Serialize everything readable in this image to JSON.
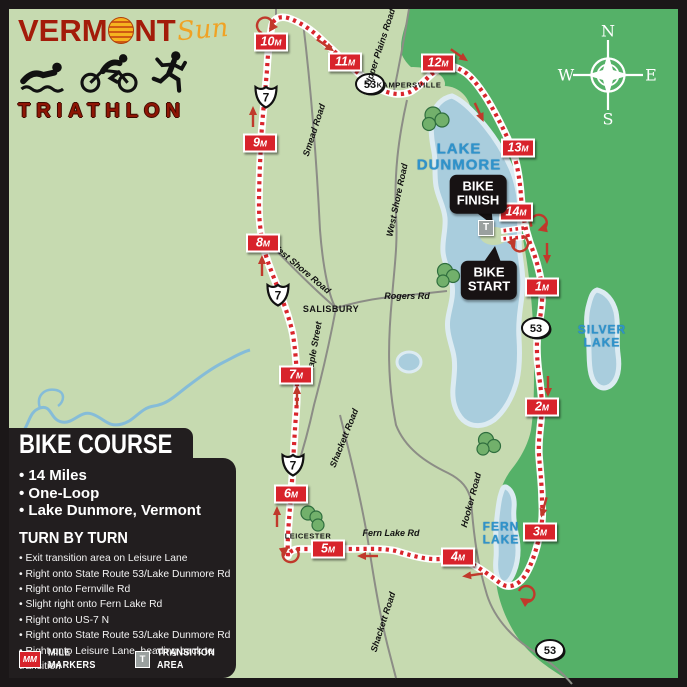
{
  "logo": {
    "brand_prefix": "VERM",
    "brand_suffix": "NT",
    "brand_script": "Sun",
    "subtitle": "TRIATHLON"
  },
  "compass": {
    "n": "N",
    "e": "E",
    "s": "S",
    "w": "W"
  },
  "map": {
    "lake_labels": [
      {
        "line1": "LAKE",
        "line2": "DUNMORE"
      },
      {
        "line1": "SILVER",
        "line2": "LAKE"
      },
      {
        "line1": "FERN",
        "line2": "LAKE"
      }
    ],
    "town_labels": [
      {
        "text": "KAMPERSVILLE"
      },
      {
        "text": "SALISBURY"
      },
      {
        "text": "LEICESTER"
      }
    ],
    "road_labels": [
      {
        "text": "Upper Plains Road"
      },
      {
        "text": "Smead Road"
      },
      {
        "text": "West Shore Road"
      },
      {
        "text": "West Shore Road"
      },
      {
        "text": "Maple Street"
      },
      {
        "text": "Shackett Road"
      },
      {
        "text": "Shackett Road"
      },
      {
        "text": "Hooker Road"
      },
      {
        "text": "Fern Lake Rd"
      },
      {
        "text": "Rogers Rd"
      }
    ],
    "shields": {
      "us7": "7",
      "vt53": "53"
    },
    "mile_suffix": "M",
    "mile_markers": [
      {
        "num": "1"
      },
      {
        "num": "2"
      },
      {
        "num": "3"
      },
      {
        "num": "4"
      },
      {
        "num": "5"
      },
      {
        "num": "6"
      },
      {
        "num": "7"
      },
      {
        "num": "8"
      },
      {
        "num": "9"
      },
      {
        "num": "10"
      },
      {
        "num": "11"
      },
      {
        "num": "12"
      },
      {
        "num": "13"
      },
      {
        "num": "14"
      }
    ],
    "callouts": {
      "finish_line1": "BIKE",
      "finish_line2": "FINISH",
      "start_line1": "BIKE",
      "start_line2": "START",
      "transition": "T"
    }
  },
  "panel": {
    "title": "BIKE COURSE",
    "bullets": [
      "• 14 Miles",
      "• One-Loop",
      "• Lake Dunmore, Vermont"
    ],
    "turn_by_turn_title": "TURN BY TURN",
    "directions": [
      "• Exit transition area on Leisure Lane",
      "• Right onto State Route 53/Lake Dunmore Rd",
      "• Right onto Fernville Rd",
      "• Slight right onto Fern Lake Rd",
      "• Right onto US-7 N",
      "• Right onto State Route 53/Lake Dunmore Rd",
      "• Right onto Leisure Lane, heading back to transition"
    ]
  },
  "legend": {
    "mm_badge": "MM",
    "mm_label": "MILE MARKERS",
    "t_badge": "T",
    "t_label": "TRANSITION AREA"
  },
  "colors": {
    "map_light_green": "#c6dab0",
    "forest_dark_green": "#55b168",
    "lake_blue": "#a9cddd",
    "lake_halo": "#dcebf2",
    "route_red": "#d9252c",
    "marker_red": "#d8232b",
    "road_gray": "#8c8d86",
    "panel_black": "#221e1f",
    "lake_text_blue": "#2f93cb",
    "brand_red": "#a31c0a",
    "sun_orange": "#f0a224"
  }
}
